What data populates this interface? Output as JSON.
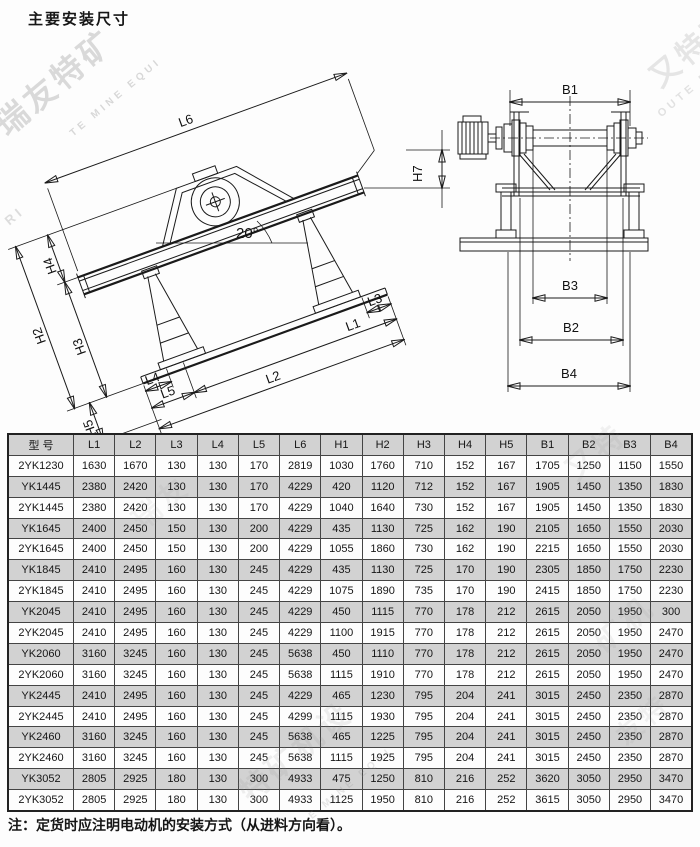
{
  "page": {
    "title": "主要安装尺寸",
    "note": "注：定货时应注明电动机的安装方式（从进料方向看）。"
  },
  "diagram": {
    "side_view": {
      "l1": "L1",
      "l2": "L2",
      "l3": "L3",
      "l4": "L4",
      "l5": "L5",
      "l6": "L6",
      "h2": "H2",
      "h3": "H3",
      "h4": "H4",
      "h5": "H5",
      "h7": "H7",
      "angle": "20°"
    },
    "front_view": {
      "b1": "B1",
      "b2": "B2",
      "b3": "B3",
      "b4": "B4"
    }
  },
  "table": {
    "headers": [
      "型 号",
      "L1",
      "L2",
      "L3",
      "L4",
      "L5",
      "L6",
      "H1",
      "H2",
      "H3",
      "H4",
      "H5",
      "B1",
      "B2",
      "B3",
      "B4"
    ],
    "rows": [
      [
        "2YK1230",
        "1630",
        "1670",
        "130",
        "130",
        "170",
        "2819",
        "1030",
        "1760",
        "710",
        "152",
        "167",
        "1705",
        "1250",
        "1150",
        "1550"
      ],
      [
        "YK1445",
        "2380",
        "2420",
        "130",
        "130",
        "170",
        "4229",
        "420",
        "1120",
        "712",
        "152",
        "167",
        "1905",
        "1450",
        "1350",
        "1830"
      ],
      [
        "2YK1445",
        "2380",
        "2420",
        "130",
        "130",
        "170",
        "4229",
        "1040",
        "1640",
        "730",
        "152",
        "167",
        "1905",
        "1450",
        "1350",
        "1830"
      ],
      [
        "YK1645",
        "2400",
        "2450",
        "150",
        "130",
        "200",
        "4229",
        "435",
        "1130",
        "725",
        "162",
        "190",
        "2105",
        "1650",
        "1550",
        "2030"
      ],
      [
        "2YK1645",
        "2400",
        "2450",
        "150",
        "130",
        "200",
        "4229",
        "1055",
        "1860",
        "730",
        "162",
        "190",
        "2215",
        "1650",
        "1550",
        "2030"
      ],
      [
        "YK1845",
        "2410",
        "2495",
        "160",
        "130",
        "245",
        "4229",
        "435",
        "1130",
        "725",
        "170",
        "190",
        "2305",
        "1850",
        "1750",
        "2230"
      ],
      [
        "2YK1845",
        "2410",
        "2495",
        "160",
        "130",
        "245",
        "4229",
        "1075",
        "1890",
        "735",
        "170",
        "190",
        "2415",
        "1850",
        "1750",
        "2230"
      ],
      [
        "YK2045",
        "2410",
        "2495",
        "160",
        "130",
        "245",
        "4229",
        "450",
        "1115",
        "770",
        "178",
        "212",
        "2615",
        "2050",
        "1950",
        "300"
      ],
      [
        "2YK2045",
        "2410",
        "2495",
        "160",
        "130",
        "245",
        "4229",
        "1100",
        "1915",
        "770",
        "178",
        "212",
        "2615",
        "2050",
        "1950",
        "2470"
      ],
      [
        "YK2060",
        "3160",
        "3245",
        "160",
        "130",
        "245",
        "5638",
        "450",
        "1110",
        "770",
        "178",
        "212",
        "2615",
        "2050",
        "1950",
        "2470"
      ],
      [
        "2YK2060",
        "3160",
        "3245",
        "160",
        "130",
        "245",
        "5638",
        "1115",
        "1910",
        "770",
        "178",
        "212",
        "2615",
        "2050",
        "1950",
        "2470"
      ],
      [
        "YK2445",
        "2410",
        "2495",
        "160",
        "130",
        "245",
        "4229",
        "465",
        "1230",
        "795",
        "204",
        "241",
        "3015",
        "2450",
        "2350",
        "2870"
      ],
      [
        "2YK2445",
        "2410",
        "2495",
        "160",
        "130",
        "245",
        "4299",
        "1115",
        "1930",
        "795",
        "204",
        "241",
        "3015",
        "2450",
        "2350",
        "2870"
      ],
      [
        "YK2460",
        "3160",
        "3245",
        "160",
        "130",
        "245",
        "5638",
        "465",
        "1225",
        "795",
        "204",
        "241",
        "3015",
        "2450",
        "2350",
        "2870"
      ],
      [
        "2YK2460",
        "3160",
        "3245",
        "160",
        "130",
        "245",
        "5638",
        "1115",
        "1925",
        "795",
        "204",
        "241",
        "3015",
        "2450",
        "2350",
        "2870"
      ],
      [
        "YK3052",
        "2805",
        "2925",
        "180",
        "130",
        "300",
        "4933",
        "475",
        "1250",
        "810",
        "216",
        "252",
        "3620",
        "3050",
        "2950",
        "3470"
      ],
      [
        "2YK3052",
        "2805",
        "2925",
        "180",
        "130",
        "300",
        "4933",
        "1125",
        "1950",
        "810",
        "216",
        "252",
        "3615",
        "3050",
        "2950",
        "3470"
      ]
    ]
  },
  "watermarks": [
    {
      "text": "瑞友特矿",
      "x": -18,
      "y": 58,
      "size": 32,
      "opacity": 0.3,
      "rot": -40
    },
    {
      "text": "TE MINE EQUI",
      "x": 58,
      "y": 92,
      "size": 10,
      "opacity": 0.32,
      "rot": -40
    },
    {
      "text": "RI",
      "x": 4,
      "y": 208,
      "size": 13,
      "opacity": 0.28,
      "rot": -40
    },
    {
      "text": "又特矿",
      "x": 640,
      "y": 24,
      "size": 30,
      "opacity": 0.2,
      "rot": -40
    },
    {
      "text": "OUTE MINE",
      "x": 648,
      "y": 78,
      "size": 11,
      "opacity": 0.24,
      "rot": -40
    },
    {
      "text": "又特",
      "x": 560,
      "y": 428,
      "size": 30,
      "opacity": 0.1,
      "rot": -40
    },
    {
      "text": "瑞友",
      "x": 128,
      "y": 482,
      "size": 28,
      "opacity": 0.09,
      "rot": -40
    },
    {
      "text": "矿机",
      "x": 588,
      "y": 600,
      "size": 30,
      "opacity": 0.1,
      "rot": -40
    },
    {
      "text": "特矿机设",
      "x": 226,
      "y": 728,
      "size": 30,
      "opacity": 0.13,
      "rot": -40
    },
    {
      "text": "E MINE EQUI",
      "x": 298,
      "y": 778,
      "size": 10,
      "opacity": 0.2,
      "rot": -40
    },
    {
      "text": "友特",
      "x": 612,
      "y": 700,
      "size": 26,
      "opacity": 0.1,
      "rot": -40
    }
  ]
}
